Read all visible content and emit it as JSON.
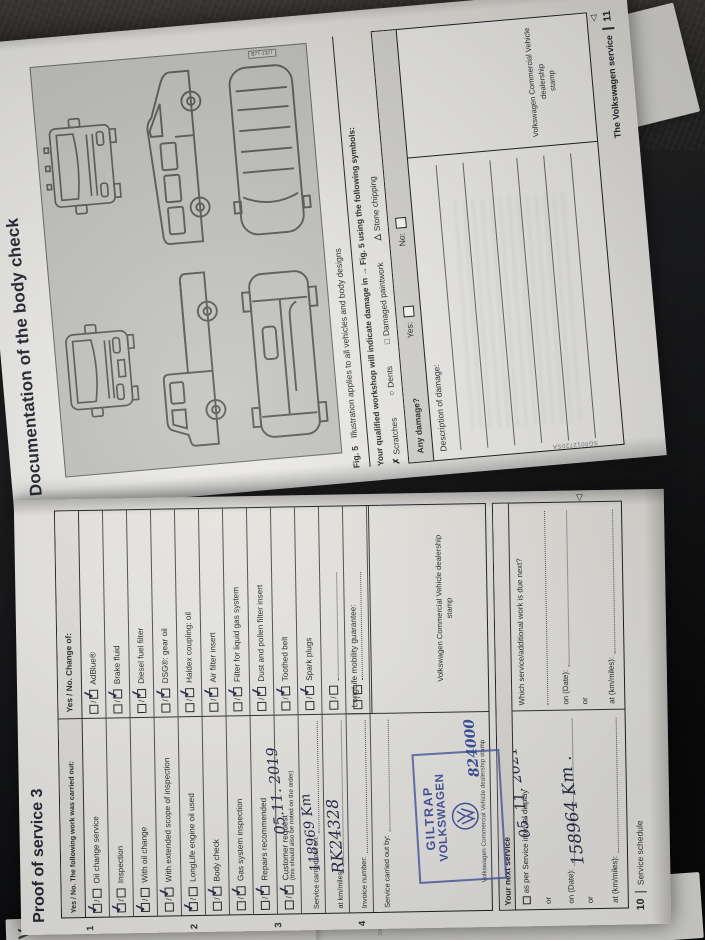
{
  "scene": {
    "background": "#17181b"
  },
  "page11": {
    "title": "Documentation of the body check",
    "figure": {
      "code": "B7T-1327",
      "caption_label": "Fig. 5",
      "caption_text": "Illustration applies to all vehicles and body designs"
    },
    "intro": "Your qualified workshop will indicate damage in → Fig. 5 using the following symbols:",
    "symbols": [
      {
        "glyph": "✗",
        "label": "Scratches"
      },
      {
        "glyph": "○",
        "label": "Dents"
      },
      {
        "glyph": "□",
        "label": "Damaged paintwork"
      },
      {
        "glyph": "△",
        "label": "Stone chipping"
      }
    ],
    "damage": {
      "question": "Any damage?",
      "yes_label": "Yes:",
      "no_label": "No:"
    },
    "description_label": "Description of damage:",
    "stamp_cell_line1": "Volkswagen Commercial Vehicle dealership",
    "stamp_cell_line2": "stamp",
    "edge_code": "SG0012720SA",
    "continuation_marker": "◁",
    "footer": {
      "text": "The Volkswagen service",
      "page": "11"
    }
  },
  "page10": {
    "title": "Proof of service 3",
    "margin_numbers": [
      "1",
      "2",
      "3",
      "4"
    ],
    "left_header": "Yes / No. The following work was carried out:",
    "right_header": "Yes / No. Change of:",
    "left_rows": [
      {
        "label": "Oil change service",
        "tick": "yes"
      },
      {
        "label": "Inspection",
        "tick": "yes"
      },
      {
        "label": "With oil change",
        "tick": "yes"
      },
      {
        "label": "With extended scope of inspection",
        "tick": "no"
      },
      {
        "label": "LongLife engine oil used",
        "tick": "yes"
      },
      {
        "label": "Body check",
        "tick": "no"
      },
      {
        "label": "Gas system inspection",
        "tick": "no"
      },
      {
        "label": "Repairs recommended",
        "tick": "no"
      },
      {
        "label": "Customer request",
        "sub": "(this should also be noted on the order)",
        "tick": "no"
      }
    ],
    "right_rows": [
      {
        "label": "AdBlue®",
        "tick": "no"
      },
      {
        "label": "Brake fluid",
        "tick": "no"
      },
      {
        "label": "Diesel fuel filter",
        "tick": "no"
      },
      {
        "label": "DSG®: gear oil",
        "tick": "no"
      },
      {
        "label": "Haldex coupling: oil",
        "tick": "no"
      },
      {
        "label": "Air filter insert",
        "tick": "no"
      },
      {
        "label": "Filter for liquid gas system",
        "tick": "no"
      },
      {
        "label": "Dust and pollen filter insert",
        "tick": "no"
      },
      {
        "label": "Toothed belt",
        "tick": "no"
      },
      {
        "label": "Spark plugs",
        "tick": "no"
      },
      {
        "label": "",
        "dotted": true,
        "tick": "none"
      },
      {
        "label": "",
        "dotted": true,
        "tick": "none"
      }
    ],
    "fields": {
      "carried_out_on": "Service carried out on:",
      "at_km": "at km/miles:",
      "invoice": "Invoice number:",
      "carried_out_by": "Service carried out by:",
      "stamp_cell": "Volkswagen Commercial Vehicle dealership stamp",
      "longlife": "LongLife mobility guarantee:",
      "stamp_cell_line1": "Volkswagen Commercial Vehicle dealership",
      "stamp_cell_line2": "stamp"
    },
    "handwriting": {
      "service_date": "05.11. 2019",
      "km": "118969 Km",
      "invoice_no": "RK24328",
      "stamp_no": "824000",
      "next_date": "05. 11. 2021",
      "next_km": "158964 Km ."
    },
    "stamp": {
      "line1": "GILTRAP",
      "line2": "VOLKSWAGEN"
    },
    "next_service": {
      "header": "Your next service",
      "interval": "as per Service interval display",
      "or": "or",
      "on_date": "on (Date):",
      "at_km": "at (km/miles):",
      "question": "Which service/additional work is due next?"
    },
    "continuation_marker": "◁",
    "footer": {
      "page": "10",
      "text": "Service schedule"
    }
  },
  "underlay": {
    "partial_letter": "V",
    "ghost1": "Fig.",
    "ghost2": "code",
    "ghost3": "Del"
  }
}
